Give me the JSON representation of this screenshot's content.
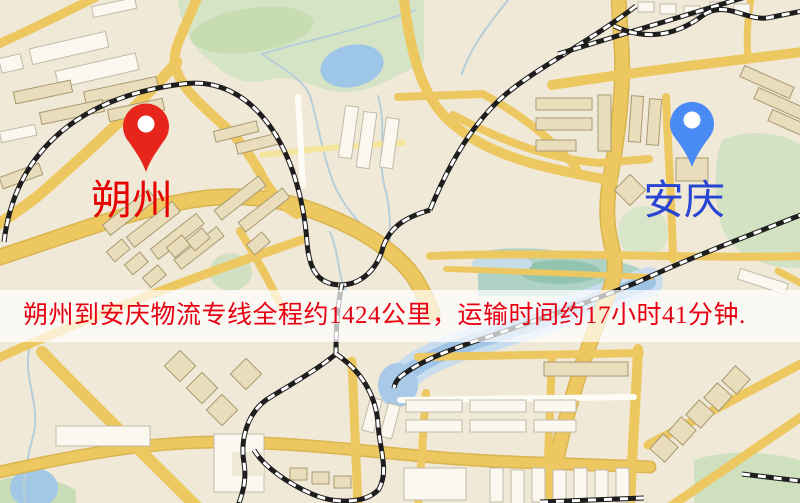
{
  "banner": {
    "text": "朔州到安庆物流专线全程约1424公里，运输时间约17小时41分钟.",
    "text_color": "#e60012",
    "background_color": "#ffffff",
    "background_opacity": 0.7
  },
  "markers": {
    "origin": {
      "label": "朔州",
      "label_color": "#e60000",
      "pin_color": "#e8251a",
      "pin_hole_color": "#ffffff"
    },
    "destination": {
      "label": "安庆",
      "label_color": "#2745d2",
      "pin_color": "#4a8af4",
      "pin_hole_color": "#ffffff"
    }
  },
  "route_info": {
    "origin": "朔州",
    "destination": "安庆",
    "service": "物流专线",
    "distance_text": "约1424公里",
    "duration_text": "约17小时41分钟"
  },
  "map_colors": {
    "land": "#f0e9d8",
    "road": "#edc75f",
    "road_casing": "#d9b552",
    "park_green": "#d6e4c6",
    "water_blue": "#9fc4e6",
    "railway_dark": "#1e1e1e",
    "building_tan": "#e9ddbb",
    "building_white": "#fbf8f0"
  }
}
